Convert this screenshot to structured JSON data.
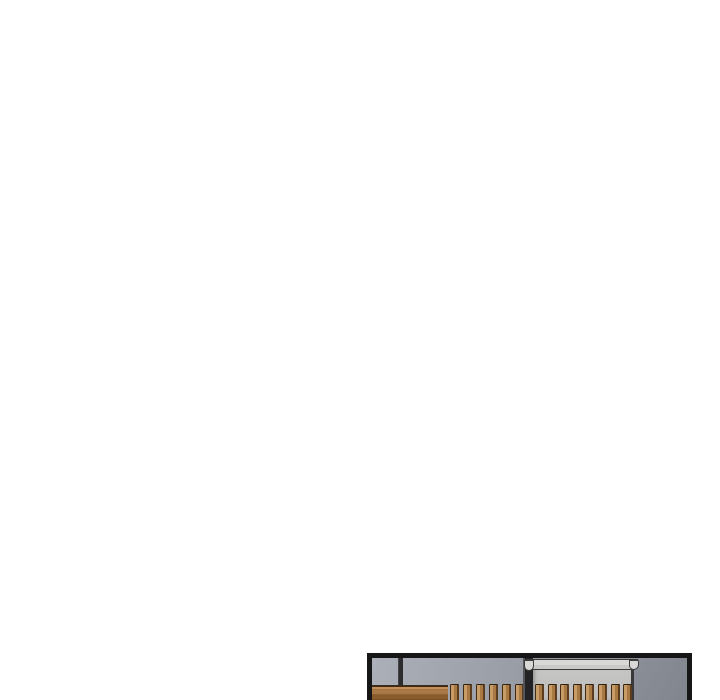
{
  "page": {
    "background_color": "#ffffff",
    "description": "Blank white comic-reader page; a single comic panel is partially visible, entering from the bottom edge"
  },
  "panel": {
    "scene": "Interior room: blue-gray wall, dark trim line, wooden counter, two groups of wooden slats, dark pillar, light gray cabinet topped with a molded cornice; panel cropped by the bottom of the screen",
    "border_color": "#161616",
    "colors": {
      "panelBorder": "#161616",
      "wallLight": "#acb0b8",
      "wallDark": "#81858d",
      "trimLine": "#2c2c2e",
      "pillarCore": "#232325",
      "pillarEdge": "#55555a",
      "woodTopLine": "#3b2b17",
      "woodHighlight": "#c49058",
      "woodBody": "#a87944",
      "woodShadow": "#8a5c2c",
      "slatLight": "#c79c66",
      "slatMid": "#a87943",
      "slatDark": "#5d3d20",
      "slatOutline": "#2e2013",
      "cabinetFace": "#c6c6c4",
      "cabinetFaceDark": "#bcbcba",
      "corniceLight": "#d8d8d6",
      "corniceLip": "#c9c9c7",
      "corniceOutline": "#3c3c3c",
      "cabinetEdgeLine": "#39393b"
    },
    "slat_groups": [
      {
        "start": 78,
        "pitch": 13,
        "count": 6
      },
      {
        "start": 163,
        "pitch": 12.6,
        "count": 8
      }
    ]
  }
}
